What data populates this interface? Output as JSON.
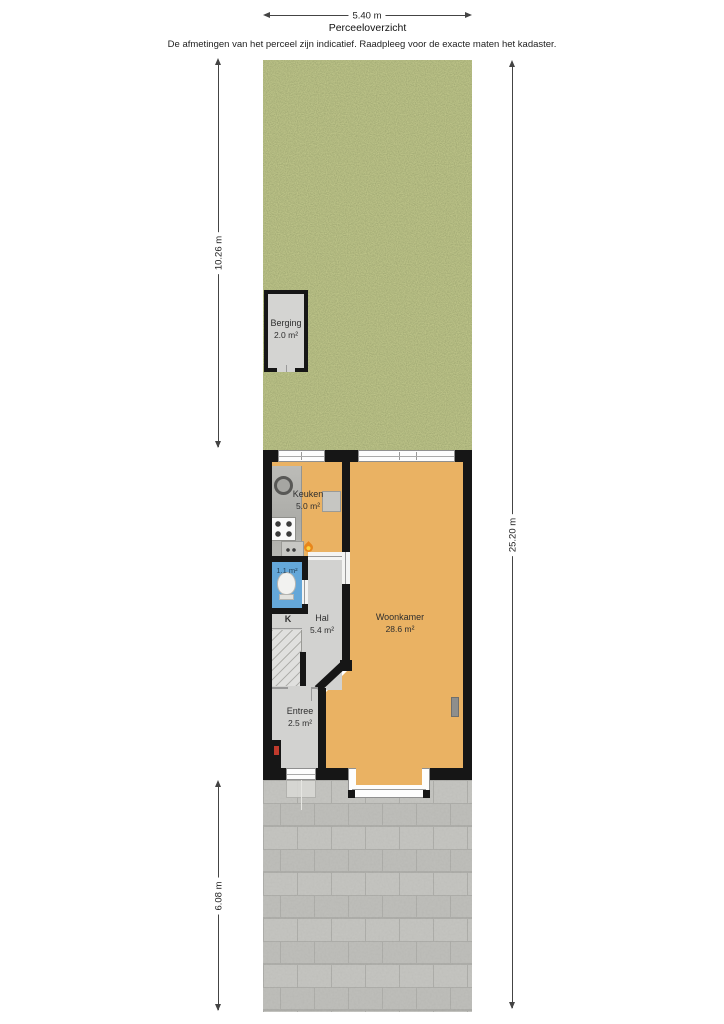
{
  "header": {
    "width_dim": "5.40 m",
    "title": "Perceeloverzicht",
    "disclaimer": "De afmetingen van het perceel zijn indicatief. Raadpleeg voor de exacte maten het kadaster."
  },
  "dimensions": {
    "garden_depth": "10.26 m",
    "plot_depth": "25.20 m",
    "front_depth": "6.08 m"
  },
  "rooms": {
    "berging": {
      "name": "Berging",
      "area": "2.0 m²"
    },
    "keuken": {
      "name": "Keuken",
      "area": "5.0 m²"
    },
    "toilet": {
      "area": "1.1 m²"
    },
    "closet": {
      "label": "K"
    },
    "hal": {
      "name": "Hal",
      "area": "5.4 m²"
    },
    "woonkamer": {
      "name": "Woonkamer",
      "area": "28.6 m²"
    },
    "entree": {
      "name": "Entree",
      "area": "2.5 m²"
    }
  },
  "colors": {
    "grass": "#76813c",
    "wood_floor": "#eab263",
    "tile_floor": "#d2d2d0",
    "toilet_floor": "#64a7d9",
    "wall": "#161616",
    "pavement": "#b6b6b2"
  }
}
